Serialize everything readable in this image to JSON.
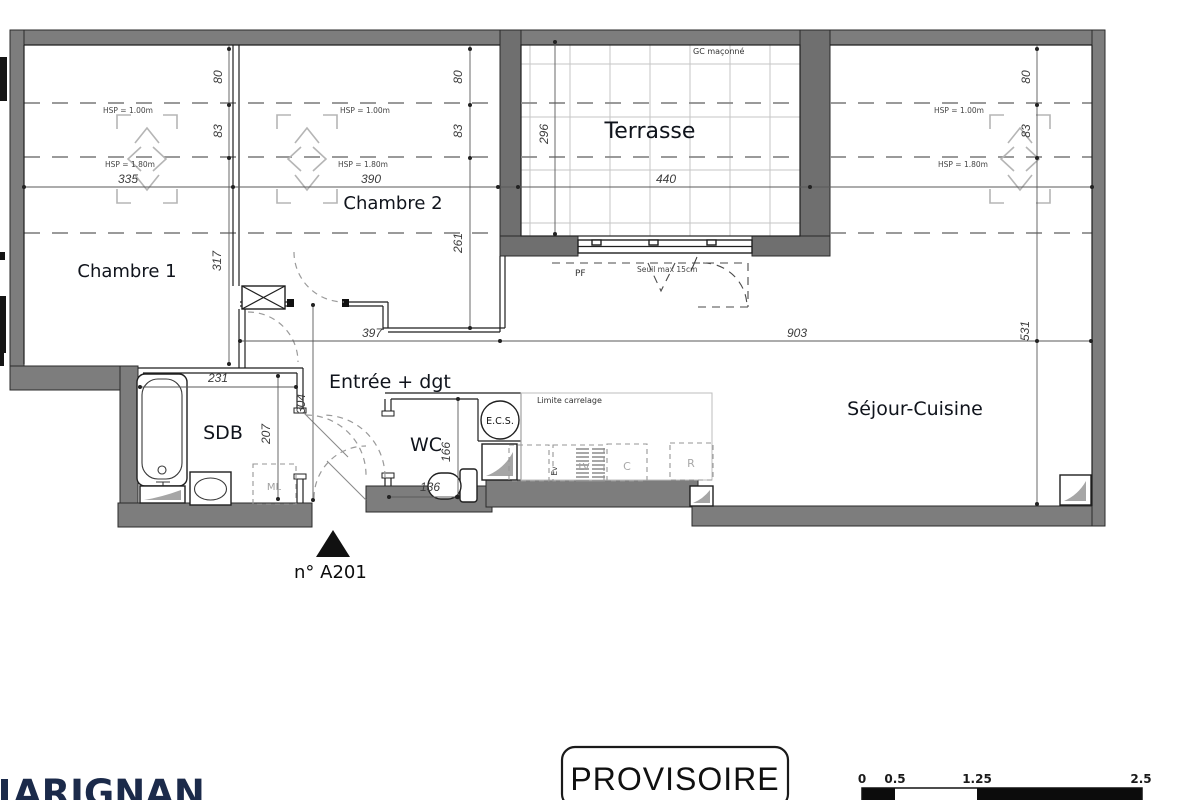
{
  "rooms": {
    "chambre1": "Chambre 1",
    "chambre2": "Chambre 2",
    "terrasse": "Terrasse",
    "entree": "Entrée + dgt",
    "sdb": "SDB",
    "wc": "WC",
    "sejour": "Séjour-Cuisine"
  },
  "annotations": {
    "gc_maconne": "GC maçonné",
    "pf": "PF",
    "seuil": "Seuil max 15cm",
    "limite_carrelage": "Limite carrelage",
    "ecs": "E.C.S.",
    "ml": "ML",
    "ev": "Ev",
    "lv": "LV",
    "cook": "C",
    "fridge": "R",
    "hsp_100": "HSP = 1.00m",
    "hsp_180": "HSP = 1.80m"
  },
  "dims": {
    "w335": "335",
    "w390": "390",
    "w440": "440",
    "h296": "296",
    "h80": "80",
    "h83": "83",
    "h317": "317",
    "h261": "261",
    "w397": "397",
    "w903": "903",
    "h531": "531",
    "w231": "231",
    "h207": "207",
    "h304": "304",
    "h166": "166",
    "w136": "136"
  },
  "footer": {
    "unit_number": "n° A201",
    "stamp": "PROVISOIRE",
    "brand": "ARIGNAN"
  },
  "scalebar": {
    "ticks": [
      "0",
      "0.5",
      "1.25",
      "2.5"
    ]
  },
  "colors": {
    "wall": "#7d7d7d",
    "terrace_wall": "#6f6f6f",
    "brand_navy": "#1b2a4a"
  }
}
